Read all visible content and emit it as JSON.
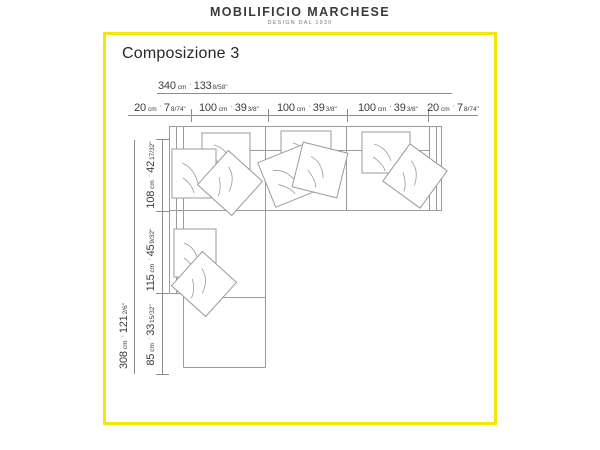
{
  "header": {
    "brand": "MOBILIFICIO MARCHESE",
    "tagline": "DESIGN DAL 1930"
  },
  "title": "Composizione 3",
  "units": {
    "cm": "cm",
    "sep": "·"
  },
  "dimensions": {
    "total_width": {
      "cm": "340",
      "in": "133",
      "frac": "8/58\""
    },
    "top_row": [
      {
        "cm": "20",
        "in": "7",
        "frac": "8/74\""
      },
      {
        "cm": "100",
        "in": "39",
        "frac": "3/8\""
      },
      {
        "cm": "100",
        "in": "39",
        "frac": "3/8\""
      },
      {
        "cm": "100",
        "in": "39",
        "frac": "3/8\""
      },
      {
        "cm": "20",
        "in": "7",
        "frac": "8/74\""
      }
    ],
    "total_depth": {
      "cm": "308",
      "in": "121",
      "frac": "2/6\""
    },
    "left_col": [
      {
        "cm": "108",
        "in": "42",
        "frac": "17/32\""
      },
      {
        "cm": "115",
        "in": "45",
        "frac": "9/32\""
      },
      {
        "cm": "85",
        "in": "33",
        "frac": "15/32\""
      }
    ]
  }
}
